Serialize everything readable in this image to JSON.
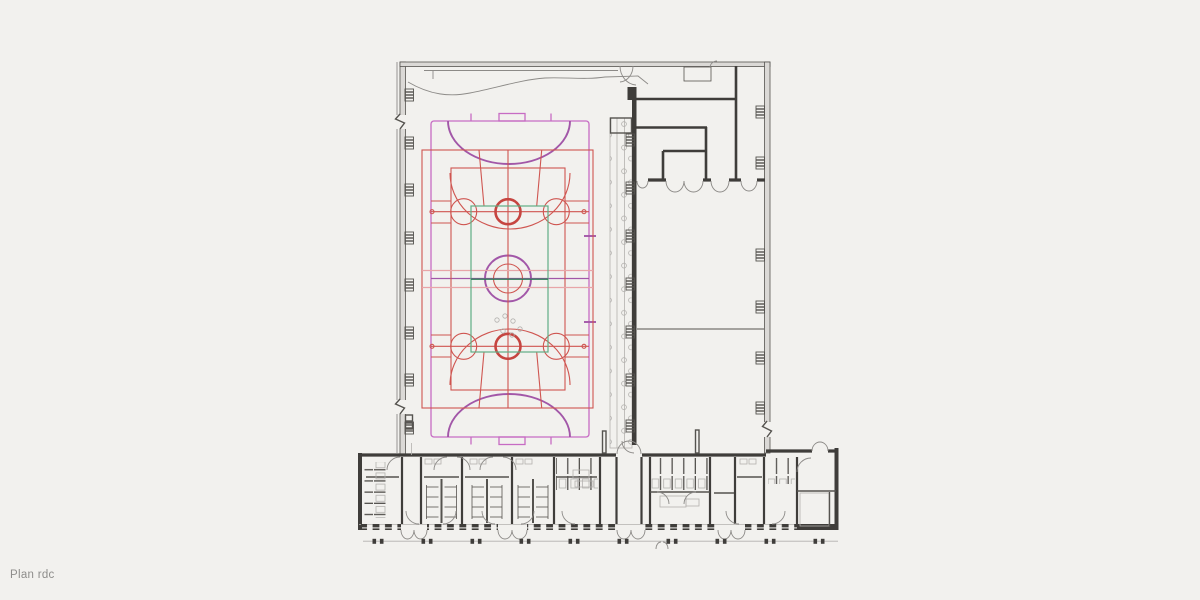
{
  "caption": {
    "label": "Plan rdc"
  },
  "drawing": {
    "type": "architectural-floor-plan"
  },
  "colors": {
    "background": "#f2f1ee",
    "wall_dark": "#3f3d3a",
    "wall_mid": "#55534f",
    "wall_thin": "#8c8a87",
    "wall_fill": "#dbd9d6",
    "detail_light": "#b3b1ae",
    "court_red": "#cf5550",
    "court_red_bold": "#c64540",
    "court_pink": "#e8a5a8",
    "court_magenta": "#c76cc4",
    "court_purple": "#a257a8",
    "court_green": "#5fae85",
    "court_green_dark": "#2f7a58",
    "label": "#8e8d8b"
  },
  "layers": [
    {
      "name": "sports-hall-shell",
      "color_key": "wall_mid"
    },
    {
      "name": "spectator-stand",
      "color_key": "detail_light"
    },
    {
      "name": "upper-right-rooms",
      "color_key": "wall_dark"
    },
    {
      "name": "changing-rooms-wing",
      "color_key": "wall_dark"
    },
    {
      "name": "handball-court",
      "color_key": "court_magenta"
    },
    {
      "name": "handball-goal-areas",
      "color_key": "court_purple"
    },
    {
      "name": "basketball-courts",
      "color_key": "court_red"
    },
    {
      "name": "volleyball-court",
      "color_key": "court_green"
    }
  ]
}
